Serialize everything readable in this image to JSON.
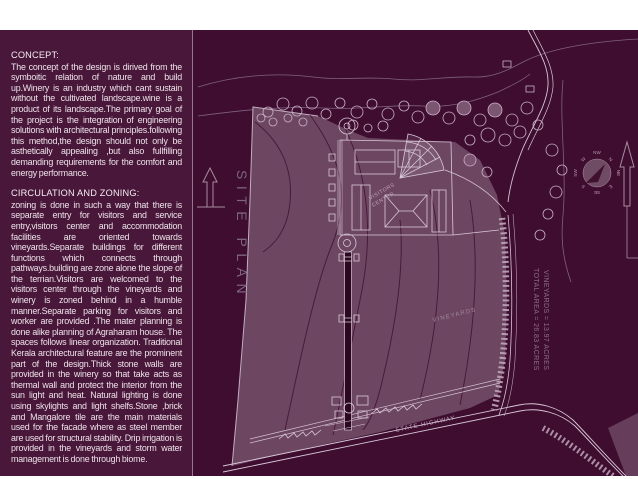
{
  "slide": {
    "background_color": "#48173a",
    "plan_background_color": "#3e0d30",
    "field_color": "#6d4762",
    "line_color": "#d8c7d7",
    "accent_text_color": "#7c6484"
  },
  "text_panel": {
    "sections": [
      {
        "heading": "CONCEPT:",
        "body": "The concept of the design is dirived from the symboitic relation of nature and build up.Winery is an industry which cant sustain without the cultivated landscape.wine is a product of its landscape.The primary goal of the project is the integration of engineering solutions with architectural principles.following this method,the design should not only be asthetically appealing ,but also fullfilling demanding requirements for the comfort and energy performance."
      },
      {
        "heading": "CIRCULATION AND ZONING:",
        "body": "zoning is done in such a way that there is separate entry for visitors and service entry,visitors center and accommodation facilities are oriented towards vineyards.Separate buildings for different functions which connects through pathways.building are zone alone the slope of the terrian.Visitors are welcomed to the visitors center through the vineyards and winery is zoned behind in a humble manner.Separate parking for visitors and worker are provided .The mater planning is done alike planning of Agraharam house. The spaces follows linear organization. Traditional Kerala architectural feature are the prominent part of the design.Thick stone walls are provided in the winery so that take acts as thermal wall and protect the interior from the sun light and heat. Natural lighting is done using skylights and light shelfs.Stone ,brick and Mangalore tile are the main materials used for the facade where as steel member are used for structural stability. Drip irrigation is provided in the vineyards and storm water management is done through biome."
      }
    ]
  },
  "site_plan": {
    "title": "SITE PLAN",
    "area_notes": {
      "total": "TOTAL AREA = 26.83 ACRES",
      "vineyards": "VINEYARDS = 13.97 ACRES"
    },
    "labels": {
      "vineyards": "VINEYARDS",
      "state_highway": "STATE HIGHWAY",
      "visitors_center_line1": "VISITORS",
      "visitors_center_line2": "CENTER"
    },
    "compass_directions": [
      "NW",
      "N",
      "NE",
      "E",
      "SE",
      "S",
      "SW",
      "W"
    ]
  }
}
